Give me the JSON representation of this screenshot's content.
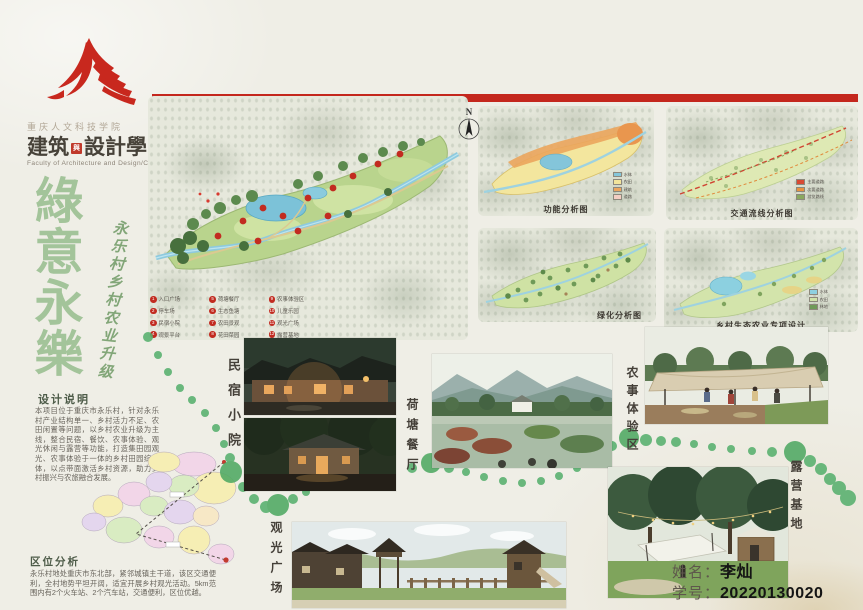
{
  "branding": {
    "university": "重庆人文科技学院",
    "faculty_prefix": "建筑",
    "faculty_seal": "與",
    "faculty_suffix": "設計學院",
    "faculty_en": "Faculty of Architecture and Design/CCHST"
  },
  "title": {
    "chars": [
      "綠",
      "意",
      "永",
      "樂"
    ],
    "subtitle": "永乐村乡村农业升级"
  },
  "design_notes": {
    "heading": "设计说明",
    "body": "本项目位于重庆市永乐村，针对永乐村产业结构单一、乡村活力不足、农田闲置等问题，以乡村农业升级为主线，整合民宿、餐饮、农事体验、观光休闲与露营等功能，打造集田园观光、农事体验于一体的乡村田园综合体，以点带面激活乡村资源，助力乡村振兴与农旅融合发展。"
  },
  "location": {
    "heading": "区位分析",
    "body": "永乐村地处重庆市东北部，紧邻城镇主干道，该区交通便利，全村地势平坦开阔，适宜开展乡村观光活动。5km范围内有2个火车站、2个汽车站，交通便利，区位优越。"
  },
  "master_plan": {
    "compass": "N",
    "legend": [
      "入口广场",
      "停车场",
      "民宿小院",
      "观景平台",
      "荷塘餐厅",
      "生态鱼塘",
      "农田景观",
      "花田菜园",
      "农事体验区",
      "儿童乐园",
      "观光广场",
      "露营基地"
    ]
  },
  "diagrams": [
    {
      "caption": "功能分析图",
      "legend": [
        {
          "color": "#85c6da",
          "label": "水体"
        },
        {
          "color": "#f2e49b",
          "label": "农田"
        },
        {
          "color": "#eca55e",
          "label": "建筑"
        },
        {
          "color": "#f3cdc2",
          "label": "道路"
        }
      ]
    },
    {
      "caption": "交通流线分析图",
      "legend": [
        {
          "color": "#d84a33",
          "label": "主要道路"
        },
        {
          "color": "#e8923f",
          "label": "次要道路"
        },
        {
          "color": "#8aa85f",
          "label": "游览路线"
        }
      ]
    },
    {
      "caption": "绿化分析图",
      "legend": []
    },
    {
      "caption": "乡村生态农业专项设计",
      "legend": [
        {
          "color": "#8ed0e0",
          "label": "水体"
        },
        {
          "color": "#cfe3a8",
          "label": "农田"
        },
        {
          "color": "#6f9a58",
          "label": "林地"
        }
      ]
    }
  ],
  "scenes": [
    {
      "label": "民宿小院"
    },
    {
      "label": "荷塘餐厅"
    },
    {
      "label": "农事体验区"
    },
    {
      "label": "观光广场"
    },
    {
      "label": "露营基地"
    }
  ],
  "footer": {
    "name_label": "姓名：",
    "name_value": "李灿",
    "id_label": "学号：",
    "id_value": "20220130020"
  }
}
